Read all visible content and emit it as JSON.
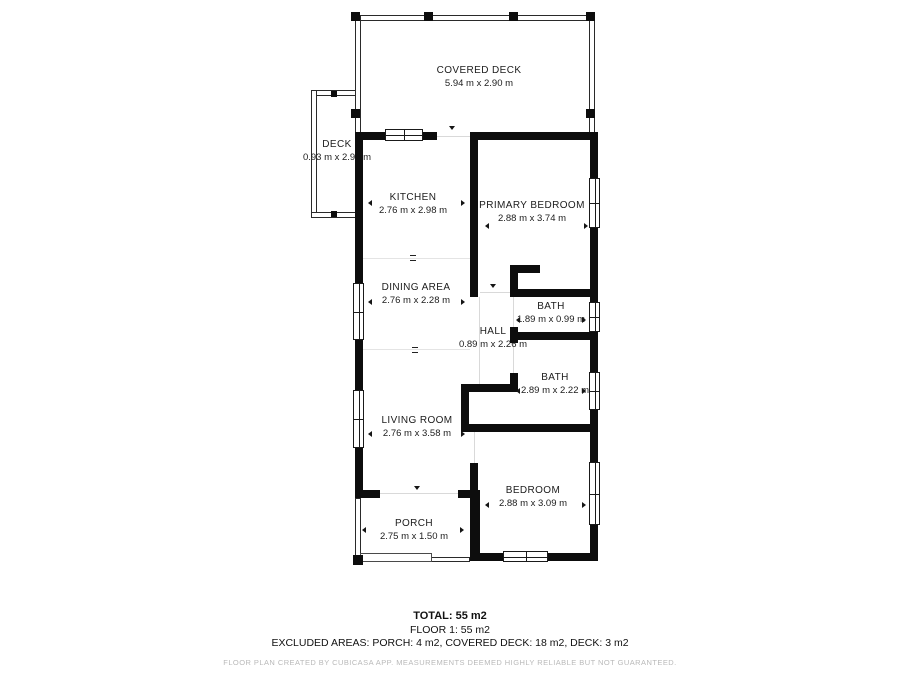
{
  "plan": {
    "rooms": [
      {
        "name": "COVERED DECK",
        "dims": "5.94 m x 2.90 m"
      },
      {
        "name": "DECK",
        "dims": "0.93 m x 2.95 m"
      },
      {
        "name": "KITCHEN",
        "dims": "2.76 m x 2.98 m"
      },
      {
        "name": "PRIMARY BEDROOM",
        "dims": "2.88 m x 3.74 m"
      },
      {
        "name": "DINING AREA",
        "dims": "2.76 m x 2.28 m"
      },
      {
        "name": "BATH",
        "dims": "1.89 m x 0.99 m"
      },
      {
        "name": "HALL",
        "dims": "0.89 m x 2.26 m"
      },
      {
        "name": "BATH",
        "dims": "2.89 m x 2.22 m"
      },
      {
        "name": "LIVING ROOM",
        "dims": "2.76 m x 3.58 m"
      },
      {
        "name": "BEDROOM",
        "dims": "2.88 m x 3.09 m"
      },
      {
        "name": "PORCH",
        "dims": "2.75 m x 1.50 m"
      }
    ]
  },
  "summary": {
    "total": "TOTAL: 55 m2",
    "floor": "FLOOR 1: 55 m2",
    "excluded": "EXCLUDED AREAS: PORCH: 4 m2, COVERED DECK: 18 m2, DECK: 3 m2"
  },
  "footer": "FLOOR PLAN CREATED BY CUBICASA APP. MEASUREMENTS DEEMED HIGHLY RELIABLE BUT NOT GUARANTEED.",
  "colors": {
    "wall": "#0d0d0d",
    "text": "#1c1c1c",
    "muted": "#b9b9b9"
  }
}
